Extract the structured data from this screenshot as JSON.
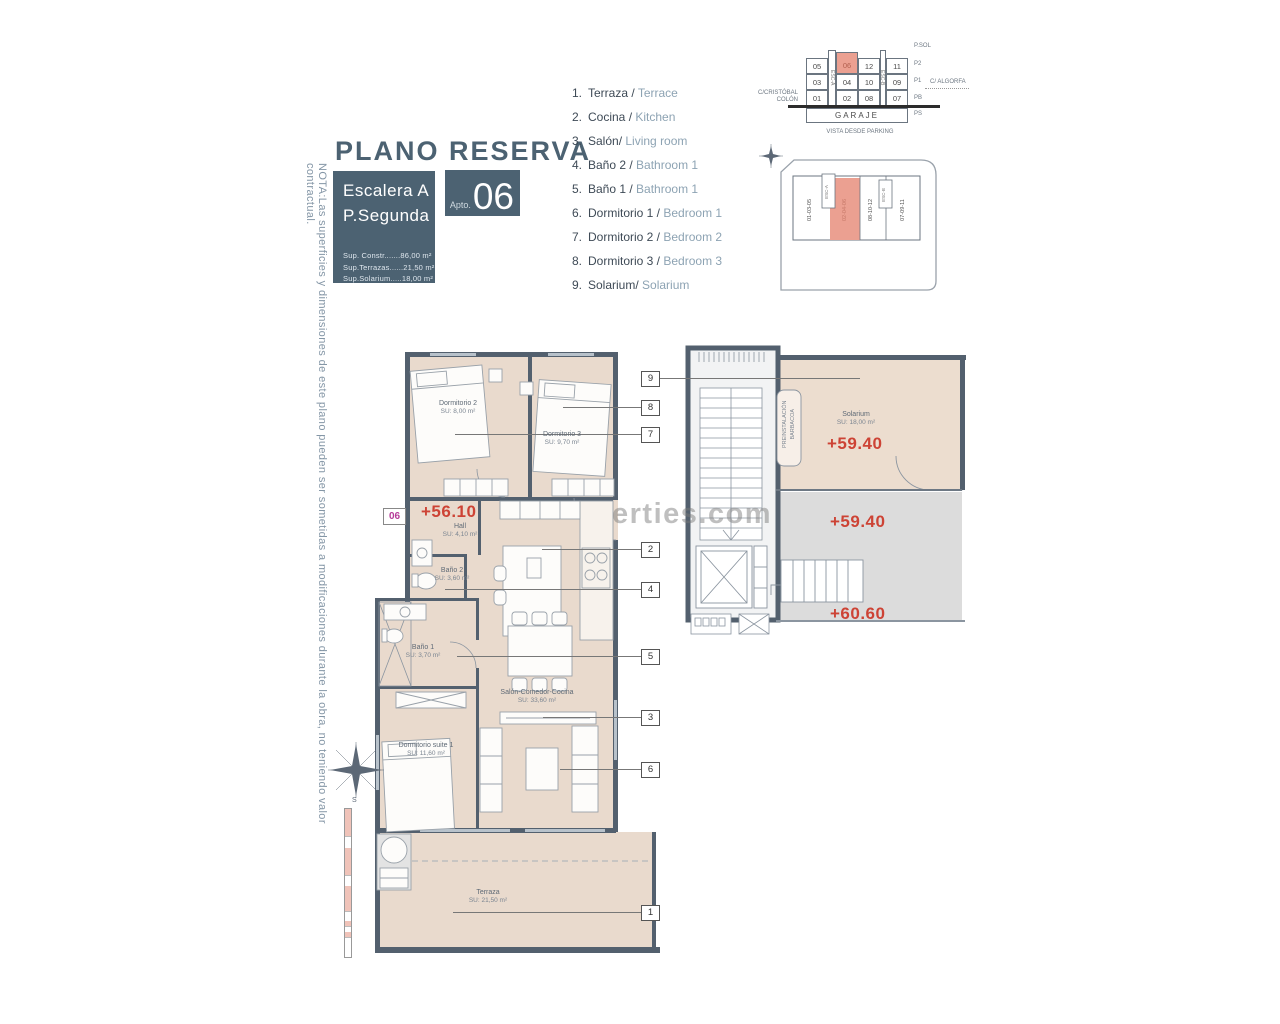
{
  "note_left": "NOTA:Las superficies y dimensiones de este plano pueden ser sometidas a modificaciones durante la obra, no teniendo valor contractual.",
  "header": {
    "title": "PLANO RESERVA",
    "block": {
      "stair": "Escalera A",
      "floor": "P.Segunda",
      "surface_lines": [
        "Sup. Constr.......86,00 m²",
        "Sup.Terrazas......21,50 m²",
        "Sup.Solarium.....18,00 m²"
      ],
      "apto_label": "Apto.",
      "apto_number": "06"
    }
  },
  "legend": {
    "items": [
      {
        "num": "1.",
        "es": "Terraza /",
        "en": "Terrace"
      },
      {
        "num": "2.",
        "es": "Cocina /",
        "en": "Kitchen"
      },
      {
        "num": "3.",
        "es": "Salón/",
        "en": "Living room"
      },
      {
        "num": "4.",
        "es": "Baño 2 /",
        "en": "Bathroom 1"
      },
      {
        "num": "5.",
        "es": "Baño 1 /",
        "en": "Bathroom 1"
      },
      {
        "num": "6.",
        "es": "Dormitorio 1 /",
        "en": "Bedroom 1"
      },
      {
        "num": "7.",
        "es": "Dormitorio 2 /",
        "en": "Bedroom 2"
      },
      {
        "num": "8.",
        "es": "Dormitorio 3 /",
        "en": "Bedroom 3"
      },
      {
        "num": "9.",
        "es": "Solarium/",
        "en": "Solarium"
      }
    ]
  },
  "garage": {
    "grid": {
      "r1": [
        "05",
        "06",
        "12",
        "11"
      ],
      "r2": [
        "03",
        "04",
        "10",
        "09"
      ],
      "r3": [
        "01",
        "02",
        "08",
        "07"
      ]
    },
    "highlight": "06",
    "esc_a": "ESC-A",
    "esc_b": "ESC-B",
    "garaje": "GARAJE",
    "street_left_1": "C/CRISTÓBAL",
    "street_left_2": "COLÓN",
    "street_right": "C/ ALGORFA",
    "floors": [
      "P.SOL",
      "P2",
      "P1",
      "PB",
      "PS"
    ],
    "caption": "VISTA DESDE PARKING"
  },
  "siteplan": {
    "stacks": [
      "01-03-05",
      "02-04-06",
      "08-10-12",
      "07-09-11"
    ],
    "highlight": "02-04-06",
    "esc_a": "ESC-A",
    "esc_b": "ESC-B"
  },
  "plan": {
    "unit_badge": "06",
    "level": "+56.10",
    "rooms": {
      "hall": {
        "name": "Hall",
        "area": "SU: 4,10 m²"
      },
      "dormitorio2": {
        "name": "Dormitorio 2",
        "area": "SU: 8,00 m²"
      },
      "dormitorio3": {
        "name": "Dormitorio 3",
        "area": "SU: 9,70 m²"
      },
      "bano2": {
        "name": "Baño 2",
        "area": "SU: 3,60 m²"
      },
      "bano1": {
        "name": "Baño 1",
        "area": "SU: 3,70 m²"
      },
      "salon": {
        "name": "Salón-Comedor-Cocina",
        "area": "SU: 33,60 m²"
      },
      "suite": {
        "name": "Dormitorio suite 1",
        "area": "SU: 11,60 m²"
      },
      "terraza": {
        "name": "Terraza",
        "area": "SU: 21,50 m²"
      }
    },
    "callouts": {
      "c1": "1",
      "c2": "2",
      "c3": "3",
      "c4": "4",
      "c5": "5",
      "c6": "6",
      "c7": "7",
      "c8": "8",
      "c9": "9"
    }
  },
  "solarium": {
    "room": {
      "name": "Solarium",
      "area": "SU: 18,00 m²"
    },
    "level_upper": "+59.40",
    "level_mid": "+59.40",
    "level_lower": "+60.60",
    "barbacoa_1": "PREINSTALACIÓN",
    "barbacoa_2": "BARBACOA"
  },
  "watermark": "erties.com",
  "compass_s": "S",
  "colors": {
    "slate": "#4c6272",
    "wall": "#53606e",
    "floor": "#e9dacd",
    "salmon": "#eba091",
    "red": "#cd4335",
    "magenta": "#b63a98"
  }
}
